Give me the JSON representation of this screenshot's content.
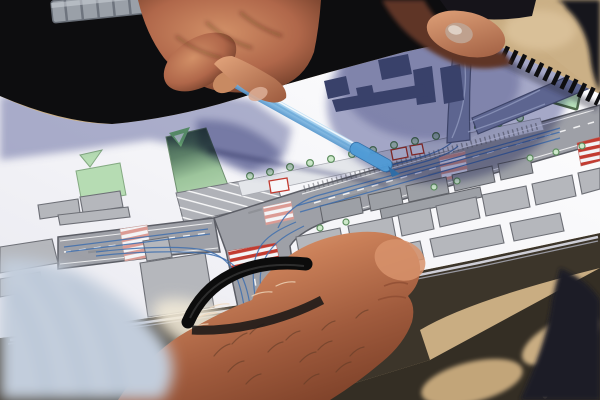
{
  "scene": {
    "type": "photograph",
    "description": "Close-up outdoor photo: hands over a spiral-bound urban street redesign plan; one hand points at the drawing with a translucent blue pen, a second person's fist with a black rubber bracelet points with a knuckle, a third hand holds the booklet edge; harsh sunlight casts a round blue head-shadow across the white plan and dark shadows on the sandy ground.",
    "objects": [
      "spiral-bound plan book",
      "translucent blue pen",
      "metal wristwatch",
      "black rubber bracelet",
      "blue striped shirt",
      "sandy ground"
    ]
  },
  "colors": {
    "sand": "#c9ad82",
    "ground_shadow": "#3c352a",
    "paper_white": "#f6f6f9",
    "shadow_on_paper": "#5b629b",
    "road_gray": "#9ea0a7",
    "road_outline": "#5c5e66",
    "green_space": "#b6dcb3",
    "green_shadowed": "#35524a",
    "tree_fill": "#cde8ca",
    "building_light": "#b5b7bc",
    "building_in_shadow": "#39416a",
    "crosswalk_red": "#c23b30",
    "crosswalk_pink": "#dc9b94",
    "lane_guide_blue": "#3e6eae",
    "pen_blue": "#8ec4ea",
    "pen_blue_dark": "#4186c2",
    "skin_lit": "#e2a072",
    "skin_shadow": "#7c4028",
    "clothing_black": "#0d0d0f",
    "binding_black": "#0e0e10",
    "shirt_blue": "#c2cddc"
  },
  "plan_drawing": {
    "kind": "urban street / traffic design plan",
    "features": [
      "main boulevard with platform and tree rows",
      "T-intersection with blue turning-lane guides",
      "red and pink zebra crosswalks",
      "angled parking bay",
      "green median strip",
      "triangular green traffic island",
      "gray building blocks",
      "blocks darkened under viewer's shadow"
    ],
    "roads": [
      {
        "tag": "path",
        "name": "road-west",
        "class": "road",
        "d": "M58,237 L172,223 Q206,219 214,218 L220,252 Q196,252 172,255 L58,269 Z"
      },
      {
        "tag": "path",
        "name": "road-main-and-south",
        "class": "road",
        "d": "M214,218 L300,191 L600,105 L600,143 L334,219 Q300,230 290,246 L302,330 L244,336 L226,251 Z"
      }
    ],
    "green_areas": [
      {
        "tag": "polygon",
        "name": "park-square",
        "class": "green",
        "points": "76,171 120,163 126,195 82,203"
      },
      {
        "tag": "polygon",
        "name": "park-triangle-small",
        "class": "green",
        "points": "80,155 102,150 90,167"
      },
      {
        "tag": "polygon",
        "name": "traffic-island-triangle",
        "class": "green-island",
        "points": "534,96 582,79 576,108"
      }
    ],
    "parking": [
      {
        "tag": "polygon",
        "name": "parking-bay-base",
        "class": "park-base",
        "points": "176,193 274,175 282,201 184,223"
      },
      {
        "tag": "polygon",
        "name": "parking-bay-stripes",
        "class": "park-stripes",
        "points": "176,193 274,175 282,201 184,223"
      }
    ],
    "road_marks": [
      {
        "tag": "path",
        "name": "edge-line",
        "class": "edgeline",
        "d": "M302,194 L594,110"
      },
      {
        "tag": "path",
        "name": "edge-line",
        "class": "edgeline",
        "d": "M338,215 L596,140"
      },
      {
        "tag": "path",
        "name": "edge-line",
        "class": "edgeline",
        "d": "M60,241 L212,223"
      },
      {
        "tag": "path",
        "name": "edge-line",
        "class": "edgeline",
        "d": "M60,264 L218,248"
      },
      {
        "tag": "path",
        "name": "center-dash",
        "class": "dashline",
        "d": "M314,203 L594,122"
      },
      {
        "tag": "path",
        "name": "center-dash",
        "class": "dashline",
        "d": "M64,252 L208,233"
      },
      {
        "tag": "path",
        "name": "center-dash",
        "class": "dashline",
        "d": "M252,264 L262,322"
      },
      {
        "tag": "path",
        "name": "curve-dash",
        "class": "dashthin",
        "d": "M506,117 Q468,141 438,161"
      },
      {
        "tag": "rect",
        "name": "micro-label",
        "class": "microtext",
        "x": 344,
        "y": 197,
        "width": 24,
        "height": 2.4,
        "transform": "rotate(-16 344 197)"
      },
      {
        "tag": "rect",
        "name": "micro-label",
        "class": "microtext",
        "x": 428,
        "y": 174,
        "width": 20,
        "height": 2.4,
        "transform": "rotate(-16 428 174)"
      },
      {
        "tag": "rect",
        "name": "micro-label",
        "class": "microtext",
        "x": 88,
        "y": 251,
        "width": 20,
        "height": 2.4,
        "transform": "rotate(-7 88 251)"
      },
      {
        "tag": "rect",
        "name": "micro-label",
        "class": "microtext",
        "x": 248,
        "y": 212,
        "width": 14,
        "height": 2.2,
        "transform": "rotate(-16 248 212)"
      }
    ],
    "crosswalks": [
      {
        "tag": "polygon",
        "name": "crosswalk-pink",
        "class": "cw-pink",
        "points": "120,229 147,225 152,257 125,261"
      },
      {
        "tag": "polygon",
        "name": "crosswalk-red",
        "class": "cw-red",
        "points": "228,251 276,243 280,263 232,271"
      },
      {
        "tag": "polygon",
        "name": "crosswalk-pink",
        "class": "cw-pink",
        "points": "263,207 291,201 294,219 266,225"
      },
      {
        "tag": "polygon",
        "name": "crosswalk-pink",
        "class": "cw-pink",
        "points": "439,157 465,151 468,175 442,181"
      },
      {
        "tag": "polygon",
        "name": "crosswalk-red",
        "class": "cw-red",
        "points": "577,143 600,137 600,161 581,166"
      }
    ],
    "shelters": [
      {
        "tag": "polygon",
        "name": "shelter",
        "class": "shelter",
        "points": "269,181 287,178 289,190 271,193"
      },
      {
        "tag": "polygon",
        "name": "shelter",
        "class": "shelter",
        "points": "391,150 406,147 408,157 393,160"
      },
      {
        "tag": "polygon",
        "name": "shelter",
        "class": "shelter",
        "points": "410,146 422,144 424,153 412,155"
      }
    ],
    "buildings": [
      {
        "tag": "polygon",
        "name": "building",
        "class": "bldg",
        "points": "38,205 78,199 80,213 40,219"
      },
      {
        "tag": "polygon",
        "name": "building",
        "class": "bldg",
        "points": "80,197 120,191 123,207 83,213"
      },
      {
        "tag": "polygon",
        "name": "building",
        "class": "bldg",
        "points": "58,215 128,207 130,217 60,225"
      },
      {
        "tag": "polygon",
        "name": "building",
        "class": "bldg",
        "points": "0,247 52,239 58,263 0,273"
      },
      {
        "tag": "polygon",
        "name": "building",
        "class": "bldg",
        "points": "143,241 168,237 172,257 147,261"
      },
      {
        "tag": "polygon",
        "name": "building",
        "class": "bldg",
        "points": "140,263 205,253 214,307 148,317"
      },
      {
        "tag": "polygon",
        "name": "building",
        "class": "bldg",
        "points": "0,279 40,272 43,289 0,297"
      },
      {
        "tag": "polygon",
        "name": "building",
        "class": "bldg-dark",
        "points": "320,206 360,197 363,213 323,222"
      },
      {
        "tag": "polygon",
        "name": "building",
        "class": "bldg-dark",
        "points": "368,195 400,188 403,204 371,211"
      },
      {
        "tag": "polygon",
        "name": "building",
        "class": "bldg-dark",
        "points": "406,186 446,177 449,193 409,202"
      },
      {
        "tag": "polygon",
        "name": "building",
        "class": "bldg-dark",
        "points": "452,175 492,166 495,182 455,191"
      },
      {
        "tag": "polygon",
        "name": "building",
        "class": "bldg-dark",
        "points": "498,164 530,157 533,173 501,180"
      },
      {
        "tag": "polygon",
        "name": "building",
        "class": "bldg-dark",
        "points": "380,209 480,187 482,197 382,219"
      },
      {
        "tag": "polygon",
        "name": "building",
        "class": "bldg",
        "points": "296,237 340,228 344,249 300,258"
      },
      {
        "tag": "polygon",
        "name": "building",
        "class": "bldg",
        "points": "348,226 392,217 396,238 352,247"
      },
      {
        "tag": "polygon",
        "name": "building",
        "class": "bldg",
        "points": "398,215 430,208 434,229 402,236"
      },
      {
        "tag": "polygon",
        "name": "building",
        "class": "bldg",
        "points": "436,206 476,197 480,218 440,227"
      },
      {
        "tag": "polygon",
        "name": "building",
        "class": "bldg",
        "points": "482,195 526,186 530,207 486,216"
      },
      {
        "tag": "polygon",
        "name": "building",
        "class": "bldg",
        "points": "532,184 572,175 576,196 536,205"
      },
      {
        "tag": "polygon",
        "name": "building",
        "class": "bldg",
        "points": "578,173 600,168 600,189 582,194"
      },
      {
        "tag": "polygon",
        "name": "building",
        "class": "bldg",
        "points": "360,253 420,241 424,259 364,271"
      },
      {
        "tag": "polygon",
        "name": "building",
        "class": "bldg",
        "points": "430,239 500,225 504,243 434,257"
      },
      {
        "tag": "polygon",
        "name": "building",
        "class": "bldg",
        "points": "510,223 560,213 564,231 514,241"
      }
    ],
    "buildings_in_shadow": [
      {
        "tag": "polygon",
        "name": "building-in-shadow",
        "class": "bldg-shadow",
        "points": "324,81 346,76 350,94 328,99"
      },
      {
        "tag": "polygon",
        "name": "building-in-shadow",
        "class": "bldg-shadow",
        "points": "378,60 408,54 412,74 382,80"
      },
      {
        "tag": "polygon",
        "name": "building-in-shadow",
        "class": "bldg-shadow",
        "points": "413,70 432,66 436,102 417,105"
      },
      {
        "tag": "polygon",
        "name": "building-in-shadow",
        "class": "bldg-shadow",
        "points": "440,68 460,64 464,100 444,104"
      },
      {
        "tag": "polygon",
        "name": "building-in-shadow",
        "class": "bldg-shadow",
        "points": "332,100 424,84 428,96 336,112"
      },
      {
        "tag": "polygon",
        "name": "building-in-shadow",
        "class": "bldg-shadow",
        "points": "356,88 372,85 375,99 359,102"
      }
    ],
    "lane_guides": [
      {
        "tag": "path",
        "name": "lane-guide",
        "class": "guide",
        "d": "M246,318 C240,278 234,258 204,250 C176,245 130,248 96,252"
      },
      {
        "tag": "path",
        "name": "lane-guide",
        "class": "guide",
        "d": "M252,317 C246,277 240,260 208,254 C180,250 130,252 96,256"
      },
      {
        "tag": "path",
        "name": "lane-guide",
        "class": "guide",
        "d": "M258,316 C252,278 250,262 262,244 C270,234 282,228 296,222"
      },
      {
        "tag": "path",
        "name": "lane-guide",
        "class": "guide",
        "d": "M264,315 C258,280 258,264 272,248 C280,238 292,232 304,226"
      },
      {
        "tag": "path",
        "name": "lane-guide",
        "class": "guide",
        "d": "M300,212 L560,138"
      },
      {
        "tag": "path",
        "name": "lane-guide",
        "class": "guide",
        "d": "M296,206 L560,132"
      },
      {
        "tag": "path",
        "name": "lane-guide",
        "class": "guide",
        "d": "M560,128 C450,160 360,184 316,196 C298,202 284,214 278,228"
      },
      {
        "tag": "path",
        "name": "lane-guide",
        "class": "guide",
        "d": "M64,247 L208,229"
      },
      {
        "tag": "path",
        "name": "lane-guide",
        "class": "guide",
        "d": "M66,252 L210,234"
      },
      {
        "tag": "path",
        "name": "lane-guide",
        "class": "guide",
        "d": "M380,168 C420,158 442,152 452,142"
      },
      {
        "tag": "path",
        "name": "lane-guide",
        "class": "guide",
        "d": "M386,172 C426,162 448,156 458,146"
      }
    ],
    "trees": [
      {
        "tag": "circle",
        "name": "tree",
        "class": "tree",
        "cx": 250,
        "cy": 176,
        "r": 3.4
      },
      {
        "tag": "circle",
        "name": "tree",
        "class": "tree",
        "cx": 270,
        "cy": 172,
        "r": 3.4
      },
      {
        "tag": "circle",
        "name": "tree",
        "class": "tree",
        "cx": 290,
        "cy": 167,
        "r": 3.4
      },
      {
        "tag": "circle",
        "name": "tree",
        "class": "tree",
        "cx": 310,
        "cy": 163,
        "r": 3.4
      },
      {
        "tag": "circle",
        "name": "tree",
        "class": "tree",
        "cx": 331,
        "cy": 159,
        "r": 3.4
      },
      {
        "tag": "circle",
        "name": "tree",
        "class": "tree",
        "cx": 352,
        "cy": 154,
        "r": 3.4
      },
      {
        "tag": "circle",
        "name": "tree",
        "class": "tree",
        "cx": 373,
        "cy": 150,
        "r": 3.4
      },
      {
        "tag": "circle",
        "name": "tree",
        "class": "tree",
        "cx": 394,
        "cy": 145,
        "r": 3.4
      },
      {
        "tag": "circle",
        "name": "tree",
        "class": "tree",
        "cx": 415,
        "cy": 141,
        "r": 3.4
      },
      {
        "tag": "circle",
        "name": "tree",
        "class": "tree",
        "cx": 436,
        "cy": 136,
        "r": 3.4
      },
      {
        "tag": "circle",
        "name": "tree",
        "class": "tree",
        "cx": 457,
        "cy": 132,
        "r": 3.4
      },
      {
        "tag": "circle",
        "name": "tree",
        "class": "tree",
        "cx": 478,
        "cy": 127,
        "r": 3.4
      },
      {
        "tag": "circle",
        "name": "tree",
        "class": "tree",
        "cx": 499,
        "cy": 123,
        "r": 3.4
      },
      {
        "tag": "circle",
        "name": "tree",
        "class": "tree",
        "cx": 520,
        "cy": 118,
        "r": 3.4
      },
      {
        "tag": "circle",
        "name": "tree",
        "class": "tree",
        "cx": 320,
        "cy": 228,
        "r": 3
      },
      {
        "tag": "circle",
        "name": "tree",
        "class": "tree",
        "cx": 346,
        "cy": 222,
        "r": 3
      },
      {
        "tag": "circle",
        "name": "tree",
        "class": "tree",
        "cx": 434,
        "cy": 187,
        "r": 3
      },
      {
        "tag": "circle",
        "name": "tree",
        "class": "tree",
        "cx": 457,
        "cy": 181,
        "r": 3
      },
      {
        "tag": "circle",
        "name": "tree",
        "class": "tree",
        "cx": 530,
        "cy": 158,
        "r": 3
      },
      {
        "tag": "circle",
        "name": "tree",
        "class": "tree",
        "cx": 556,
        "cy": 152,
        "r": 3
      },
      {
        "tag": "circle",
        "name": "tree",
        "class": "tree",
        "cx": 582,
        "cy": 146,
        "r": 3
      }
    ]
  }
}
